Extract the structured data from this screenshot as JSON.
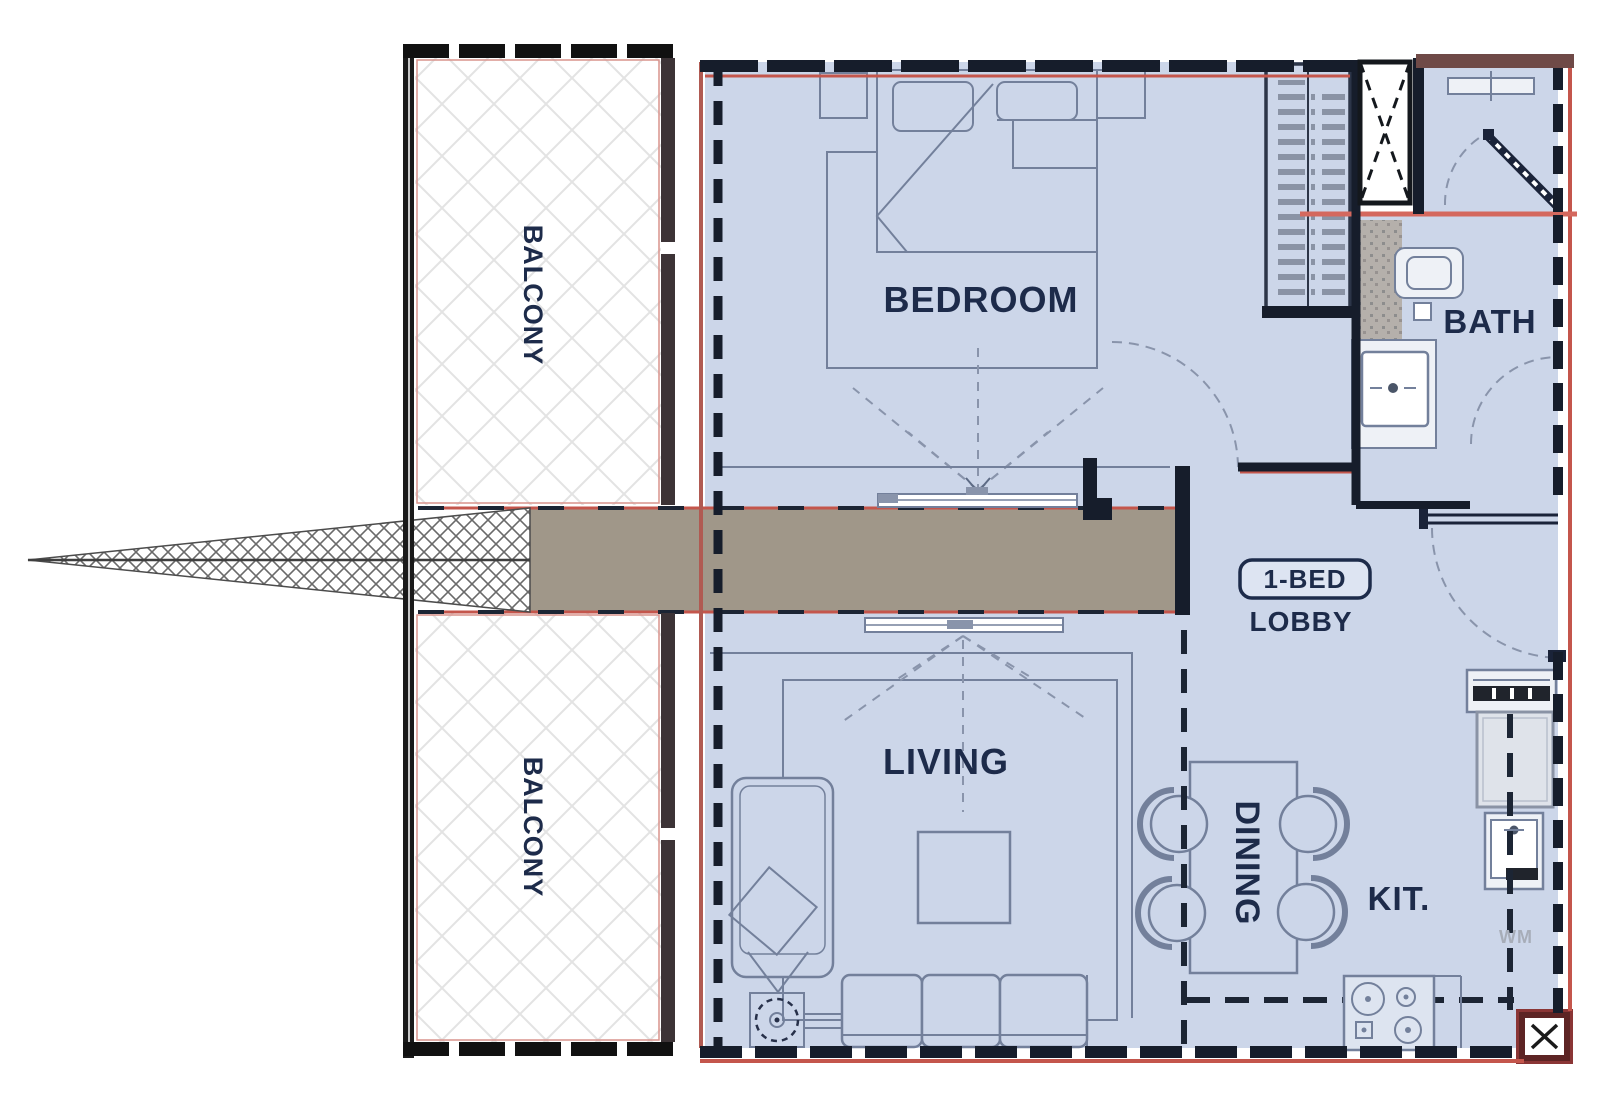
{
  "plan": {
    "type": "apartment-floor-plan",
    "unit_badge": "1-BED",
    "labels": {
      "balcony_top": "BALCONY",
      "balcony_bottom": "BALCONY",
      "bedroom": "BEDROOM",
      "bath": "BATH",
      "lobby": "LOBBY",
      "living": "LIVING",
      "dining": "DINING",
      "kitchen": "KIT.",
      "washing_machine": "WM"
    },
    "colors": {
      "room_fill": "#ccd6e9",
      "wall_dark": "#161d2b",
      "accent_red": "#c4564c",
      "salmon_line": "#d4685e",
      "maroon": "#6f4a47",
      "corridor_gray": "#a09789",
      "furniture_line": "#73809b",
      "label_text": "#1d2b4a",
      "lattice_line": "#e3e3e3",
      "tile_speckle": "#b5b0ab"
    }
  }
}
